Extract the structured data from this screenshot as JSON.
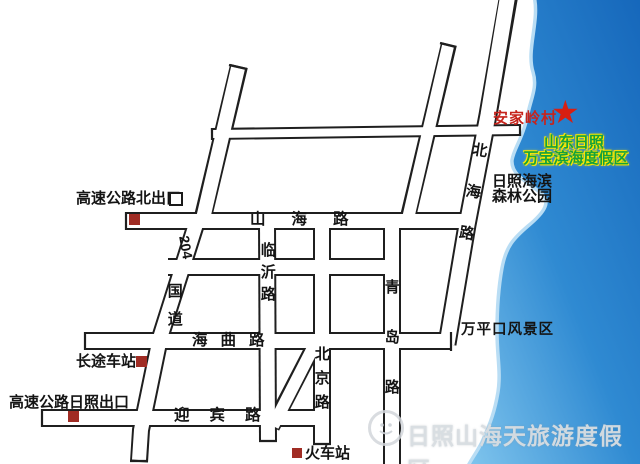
{
  "map_labels": {
    "highway_north_exit": "高速公路北出口",
    "highway_rizhao_exit": "高速公路日照出口",
    "bus_station": "长途车站",
    "train_station": "火车站",
    "wanpingkou_scenic": "万平口风景区",
    "anjialing_village": "安家岭村",
    "resort_line1": "山东日照",
    "resort_line2": "万宝滨海度假区",
    "forest_park_line1": "日照海滨",
    "forest_park_line2": "森林公园"
  },
  "roads": {
    "shanhai": "山海路",
    "haiqu": "海曲路",
    "yingbin": "迎宾路",
    "linyi": "临沂路",
    "beijing": "北京路",
    "qingdao": "青岛路",
    "beihai": "北海路",
    "route_204": "204",
    "national_road": "国道"
  },
  "watermark": {
    "text": "日照山海天旅游度假区"
  },
  "icons": {
    "star": "★"
  },
  "colors": {
    "sea_deep": "#1566ba",
    "sea_mid": "#2f8ad2",
    "sea_light": "#7cc2ec",
    "coast_rim": "#b9ddf4",
    "road_casing": "#1f1f1f",
    "marker_red": "#a02c24",
    "star_red": "#d81f12",
    "village_red": "#c6231b",
    "resort_green": "#17a13b",
    "resort_glow": "#ffe900"
  }
}
